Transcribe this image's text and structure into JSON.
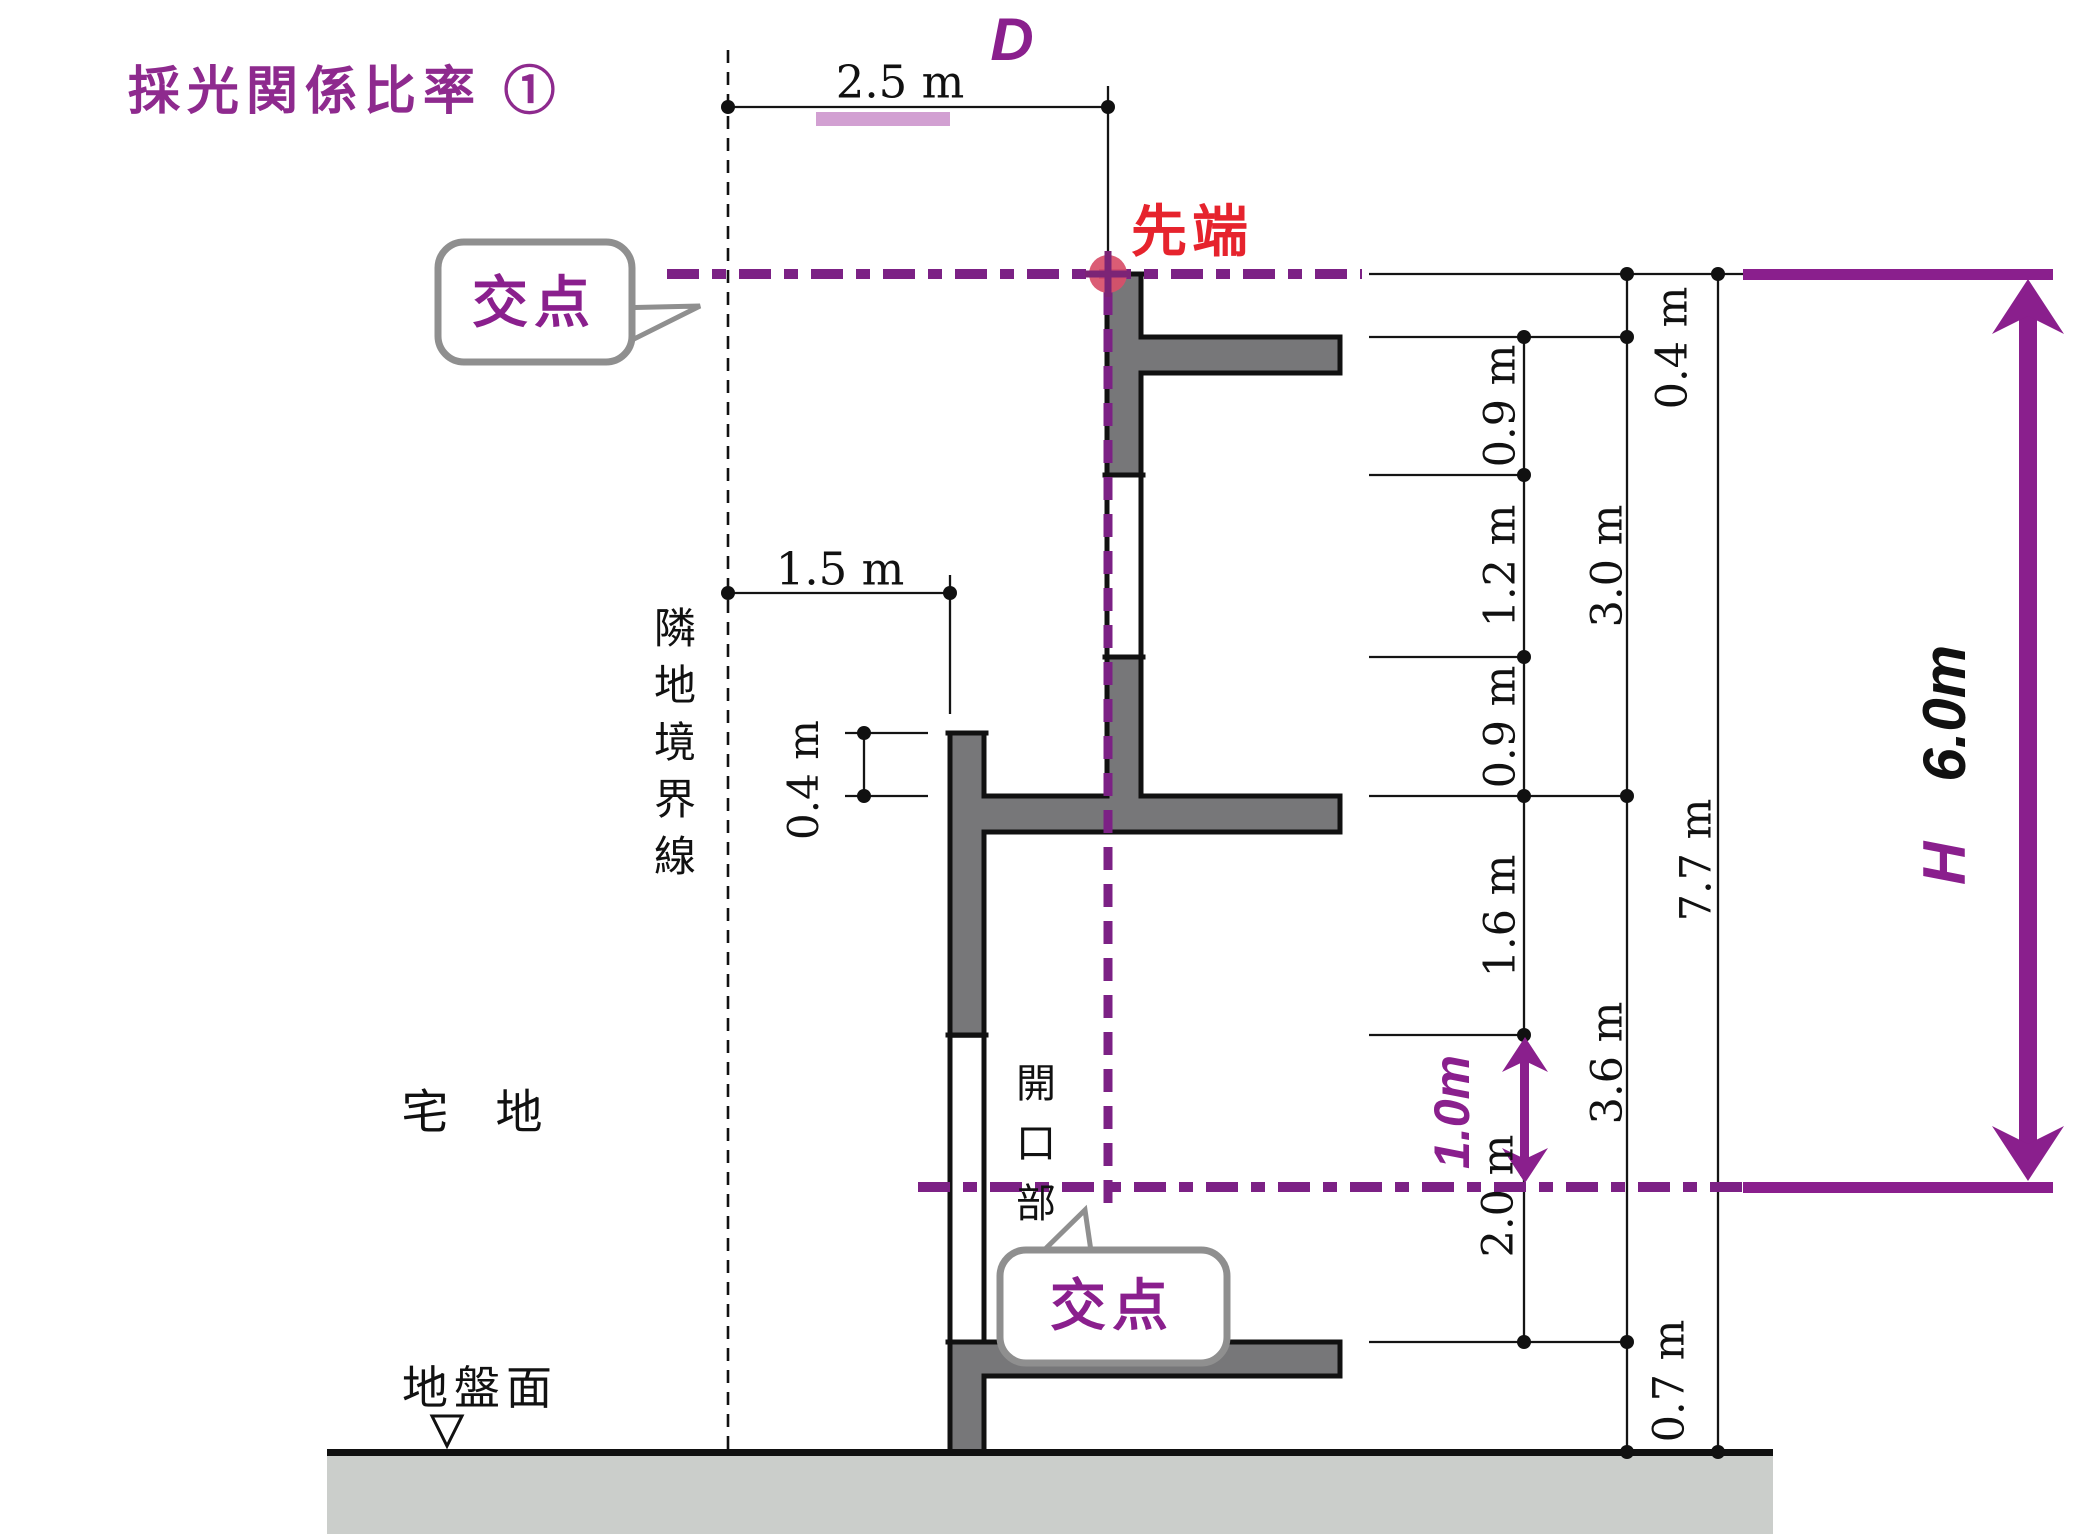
{
  "title": "採光関係比率 ①",
  "top_dimension": {
    "d_symbol": "D",
    "width": "2.5 m"
  },
  "tip_label": "先端",
  "callout_top": "交点",
  "callout_bottom": "交点",
  "boundary_label": "隣地境界線",
  "setback_dimension": "1.5 m",
  "parapet_dimension": "0.4 m",
  "lot_label": "宅　地",
  "ground_label": "地盤面",
  "opening_label": "開口部",
  "right_dimensions": {
    "inner_chain": [
      "0.9 m",
      "1.2 m",
      "0.9 m",
      "1.6 m",
      "2.0 m"
    ],
    "middle_chain": [
      "0.4 m",
      "3.0 m",
      "3.6 m",
      "0.7 m"
    ],
    "total": "7.7 m"
  },
  "height_annotation": {
    "symbol": "H",
    "value": "6.0m"
  },
  "window_center_offset": "1.0m",
  "colors": {
    "purple_text": "#8a1f8d",
    "purple_dash": "#7c2185",
    "red_label": "#e6232d",
    "red_dot": "#d8506b",
    "wall_gray": "#777779",
    "ground_gray": "#cbcecb",
    "pink_bar": "#d2a0d2",
    "bubble_border": "#8f8f8f"
  }
}
